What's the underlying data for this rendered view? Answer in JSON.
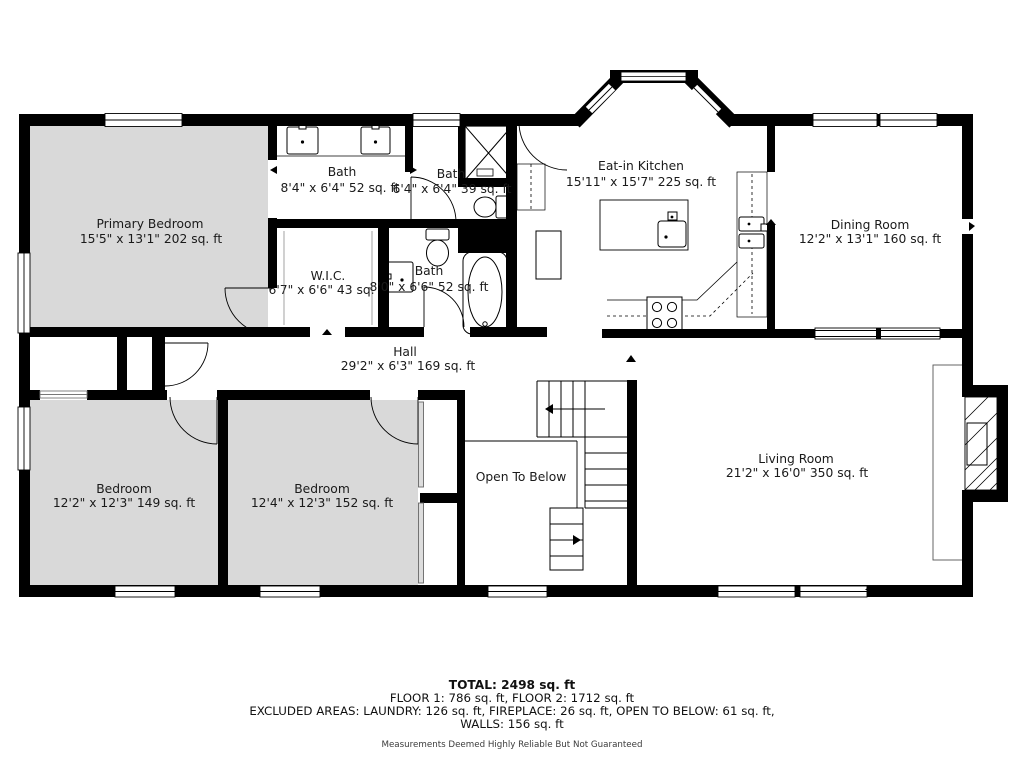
{
  "plan": {
    "rooms": [
      {
        "id": "primary-bedroom",
        "name": "Primary Bedroom",
        "dims": "15'5\" x 13'1\" 202 sq. ft"
      },
      {
        "id": "bath-ensuite",
        "name": "Bath",
        "dims": "8'4\" x 6'4\" 52 sq. ft"
      },
      {
        "id": "bath-shower",
        "name": "Bath",
        "dims": "6'4\" x 6'4\" 39 sq. ft"
      },
      {
        "id": "eat-in-kitchen",
        "name": "Eat-in Kitchen",
        "dims": "15'11\" x 15'7\" 225 sq. ft"
      },
      {
        "id": "dining-room",
        "name": "Dining Room",
        "dims": "12'2\" x 13'1\" 160 sq. ft"
      },
      {
        "id": "wic",
        "name": "W.I.C.",
        "dims": "6'7\" x 6'6\" 43 sq. ft"
      },
      {
        "id": "bath-hall",
        "name": "Bath",
        "dims": "8'0\" x 6'6\" 52 sq. ft"
      },
      {
        "id": "hall",
        "name": "Hall",
        "dims": "29'2\" x 6'3\" 169 sq. ft"
      },
      {
        "id": "bedroom-left",
        "name": "Bedroom",
        "dims": "12'2\" x 12'3\" 149 sq. ft"
      },
      {
        "id": "bedroom-right",
        "name": "Bedroom",
        "dims": "12'4\" x 12'3\" 152 sq. ft"
      },
      {
        "id": "open-to-below",
        "name": "Open To Below",
        "dims": ""
      },
      {
        "id": "living-room",
        "name": "Living Room",
        "dims": "21'2\" x 16'0\" 350 sq. ft"
      }
    ],
    "summary": {
      "total": "TOTAL: 2498 sq. ft",
      "floors": "FLOOR 1: 786 sq. ft, FLOOR 2: 1712 sq. ft",
      "excluded": "EXCLUDED AREAS: LAUNDRY: 126 sq. ft, FIREPLACE: 26 sq. ft, OPEN TO BELOW: 61 sq. ft,",
      "excluded2": "WALLS: 156 sq. ft",
      "disclaimer": "Measurements Deemed Highly Reliable But Not Guaranteed"
    },
    "colors": {
      "wall": "#000000",
      "bedroom_fill": "#d9d9d9"
    },
    "fixtures": [
      "shower-icon",
      "bathtub-icon",
      "toilet-icon",
      "sink-icon",
      "kitchen-island",
      "range-icon",
      "refrigerator-icon",
      "fireplace-icon",
      "staircase-icon",
      "bay-window",
      "door-arc",
      "window"
    ]
  }
}
